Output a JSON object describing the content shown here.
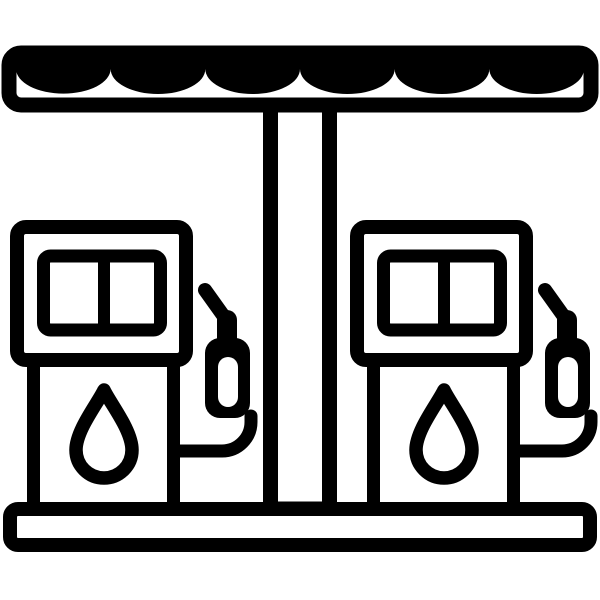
{
  "icon": {
    "label": "Gas station icon with scalloped canopy and two fuel pumps",
    "scallop_count": 6,
    "pump_count": 2,
    "parts": {
      "canopy": "scalloped-awning-canopy",
      "pillar": "support-pillar",
      "pump_left": "fuel-pump-left",
      "pump_right": "fuel-pump-right",
      "display": "price-display",
      "droplet": "fuel-droplet",
      "hose": "fuel-hose",
      "nozzle": "fuel-nozzle",
      "base": "base-platform"
    }
  },
  "colors": {
    "ink": "#000000",
    "paper": "#ffffff"
  }
}
